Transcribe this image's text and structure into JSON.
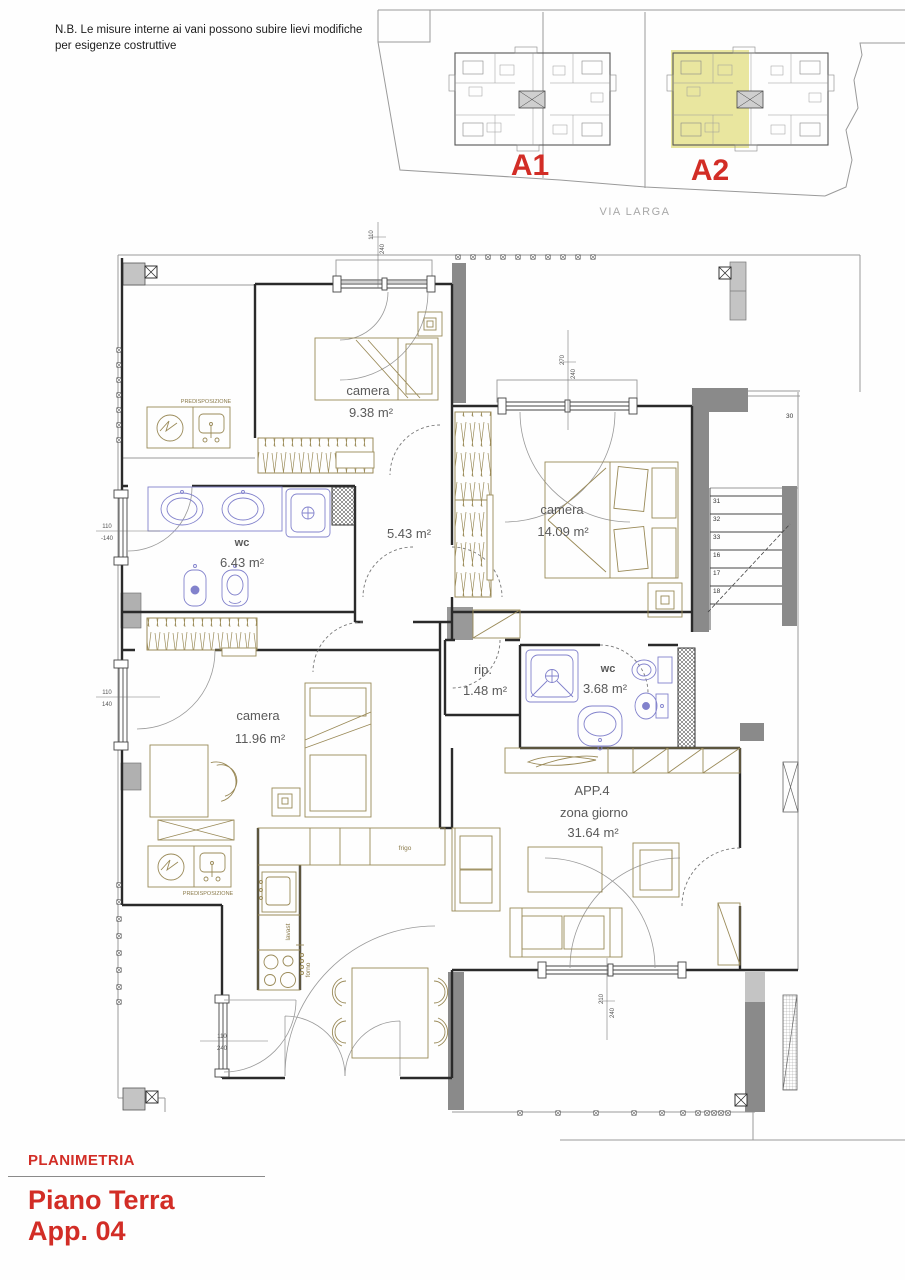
{
  "note": {
    "line1": "N.B. Le misure interne ai vani  possono subire lievi modifiche",
    "line2": "per esigenze costruttive"
  },
  "site_plan": {
    "building_a1": "A1",
    "building_a2": "A2",
    "street": "VIA LARGA"
  },
  "rooms": {
    "camera_top": {
      "name": "camera",
      "area": "9.38 m²"
    },
    "camera_right": {
      "name": "camera",
      "area": "14.09 m²"
    },
    "bath_main": {
      "name": "wc",
      "area": "6.43 m²"
    },
    "hallway": {
      "area": "5.43 m²"
    },
    "camera_left": {
      "name": "camera",
      "area": "11.96 m²"
    },
    "storage": {
      "name": "rip.",
      "area": "1.48 m²"
    },
    "bath_small": {
      "name": "wc",
      "area": "3.68 m²"
    },
    "living": {
      "id": "APP.4",
      "name": "zona giorno",
      "area": "31.64 m²"
    }
  },
  "kitchen": {
    "fridge": "frigo",
    "dishwasher": "lavast",
    "oven": "forno"
  },
  "laundry": {
    "predisposizione_top": "PREDISPOSIZIONE",
    "predisposizione_bottom": "PREDISPOSIZIONE"
  },
  "stairs": {
    "steps": [
      "31",
      "32",
      "33",
      "16",
      "17",
      "18"
    ],
    "landing": "30"
  },
  "dimensions": {
    "top_window": {
      "w": "110",
      "h": "240"
    },
    "camera_right_window": {
      "w": "270",
      "h": "240"
    },
    "bath_window": {
      "w": "110",
      "h": "-140"
    },
    "camera_left_window": {
      "w": "110",
      "h": "140"
    },
    "kitchen_window": {
      "w": "110",
      "h": "240"
    },
    "living_window": {
      "w": "210",
      "h": "240"
    }
  },
  "footer": {
    "section": "PLANIMETRIA",
    "floor": "Piano Terra",
    "apartment": "App. 04"
  },
  "colors": {
    "accent_red": "#d22d26",
    "highlight_yellow": "#e8e59a",
    "furniture_tan": "#9a8a58",
    "fixture_blue": "#8282cc",
    "wall_gray": "#8a8a8a"
  }
}
